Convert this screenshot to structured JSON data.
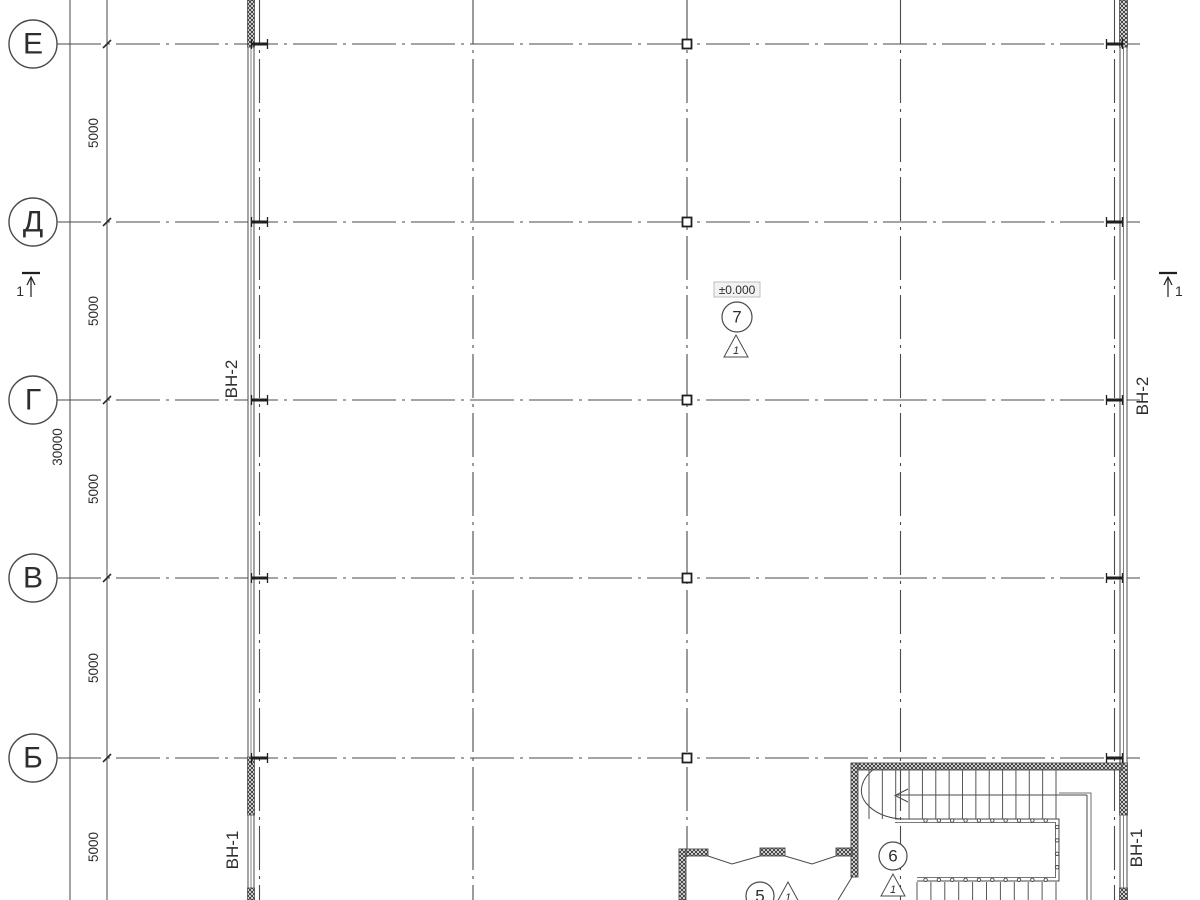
{
  "meta": {
    "drawing_type": "architectural floor plan (Russian construction drawing)",
    "level_shown": "first floor"
  },
  "colors": {
    "line": "#4a4a4a",
    "dark": "#2e2e2e",
    "wall": "#3a3a3a",
    "level_box_bg": "#f2f2f2",
    "level_box_border": "#b0b0b0"
  },
  "row_axes": [
    {
      "label": "Е",
      "y": 44
    },
    {
      "label": "Д",
      "y": 222
    },
    {
      "label": "Г",
      "y": 400
    },
    {
      "label": "В",
      "y": 578
    },
    {
      "label": "Б",
      "y": 758
    }
  ],
  "col_axes": [
    {
      "x": 259.5,
      "marker": "flange"
    },
    {
      "x": 473,
      "marker": "none"
    },
    {
      "x": 687,
      "marker": "square"
    },
    {
      "x": 900.5,
      "marker": "none"
    },
    {
      "x": 1114.5,
      "marker": "flange"
    }
  ],
  "dimensions": {
    "segment_labels": [
      {
        "text": "5000",
        "y": 133
      },
      {
        "text": "5000",
        "y": 311
      },
      {
        "text": "5000",
        "y": 489
      },
      {
        "text": "5000",
        "y": 668
      },
      {
        "text": "5000",
        "y": 847
      }
    ],
    "total": {
      "text": "30000",
      "y": 447
    }
  },
  "wall_tags": [
    {
      "text": "ВН-2",
      "x": 237,
      "y": 379
    },
    {
      "text": "ВН-1",
      "x": 238,
      "y": 850
    },
    {
      "text": "ВН-2",
      "x": 1148,
      "y": 396
    },
    {
      "text": "ВН-1",
      "x": 1142,
      "y": 848
    }
  ],
  "level_mark": {
    "text": "±0.000",
    "x": 737,
    "y": 290
  },
  "callouts": [
    {
      "number": "7",
      "cx": 737,
      "cy": 317,
      "r": 15,
      "detail": "1",
      "tx": 736,
      "ty": 346
    },
    {
      "number": "6",
      "cx": 893,
      "cy": 856,
      "r": 14,
      "detail": "1",
      "tx": 893,
      "ty": 885
    },
    {
      "number": "5",
      "cx": 760,
      "cy": 896,
      "r": 14,
      "detail": "1",
      "tx": 788,
      "ty": 893
    }
  ],
  "section_marks": [
    {
      "label": "1",
      "x": 31,
      "y": 285,
      "label_side": "left"
    },
    {
      "label": "1",
      "x": 1168,
      "y": 285,
      "label_side": "right"
    }
  ]
}
